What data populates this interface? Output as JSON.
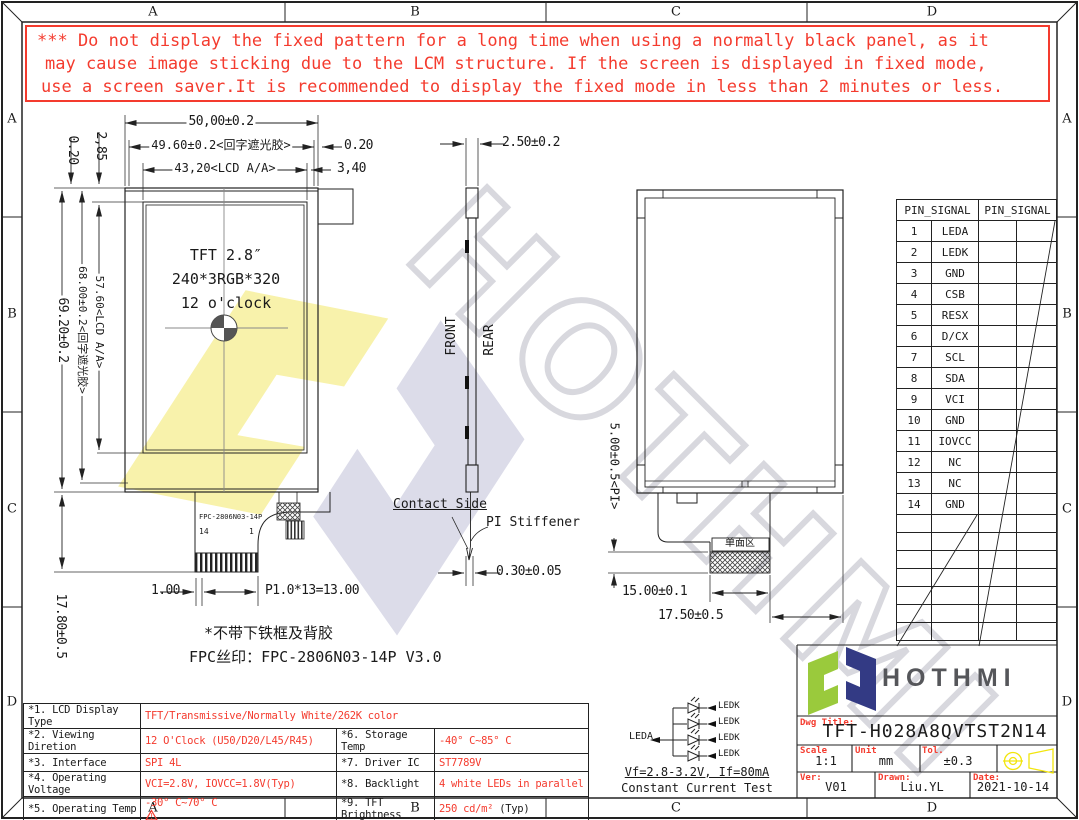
{
  "frame": {
    "cols": [
      "A",
      "B",
      "C",
      "D"
    ],
    "rows": [
      "A",
      "B",
      "C",
      "D"
    ]
  },
  "warning": {
    "line1": "*** Do not display the fixed pattern for a long time when using a normally black panel, as it",
    "line2": "may cause image sticking due to the LCM structure. If the screen is displayed in fixed mode,",
    "line3": "use a screen saver.It is recommended to display the fixed mode in less than 2 minutes or less."
  },
  "front_view": {
    "dim_width_outer": "50,00±0.2",
    "dim_width_mask": "49.60±0.2<回字遮光胶>",
    "dim_mask_gap": "0.20",
    "dim_width_aa": "43,20<LCD A/A>",
    "dim_aa_gap": "3,40",
    "dim_top_offset1": "2,85",
    "dim_top_offset2": "0.20",
    "dim_height_outer": "69.20±0.2",
    "dim_height_mask": "68.00±0.2<回字遮光胶>",
    "dim_height_aa": "57.60<LCD A/A>",
    "dim_fpc_drop": "17.80±0.5",
    "panel_line1": "TFT 2.8″",
    "panel_line2": "240*3RGB*320",
    "panel_line3": "12 o'clock",
    "fpc_silk": "FPC-2806N03-14P",
    "fpc_pin_left": "14",
    "fpc_pin_right": "1",
    "dim_finger_margin": "1.00",
    "dim_finger_pitch": "P1.0*13=13.00",
    "note_no_frame": "*不带下铁框及背胶",
    "note_silk": "FPC丝印：FPC-2806N03-14P V3.0"
  },
  "side_view": {
    "dim_thickness": "2.50±0.2",
    "label_front": "FRONT",
    "label_rear": "REAR",
    "label_contact": "Contact Side",
    "label_stiffener": "PI Stiffener",
    "dim_fpc_thickness": "0.30±0.05"
  },
  "rear_view": {
    "dim_pi": "5.00±0.5<PI>",
    "label_single_side": "单面区",
    "dim_fpc_width": "15.00±0.1",
    "dim_fpc_offset": "17.50±0.5"
  },
  "pin_table": {
    "header_left": "PIN_SIGNAL",
    "header_right": "PIN_SIGNAL",
    "rows": [
      [
        "1",
        "LEDA"
      ],
      [
        "2",
        "LEDK"
      ],
      [
        "3",
        "GND"
      ],
      [
        "4",
        "CSB"
      ],
      [
        "5",
        "RESX"
      ],
      [
        "6",
        "D/CX"
      ],
      [
        "7",
        "SCL"
      ],
      [
        "8",
        "SDA"
      ],
      [
        "9",
        "VCI"
      ],
      [
        "10",
        "GND"
      ],
      [
        "11",
        "IOVCC"
      ],
      [
        "12",
        "NC"
      ],
      [
        "13",
        "NC"
      ],
      [
        "14",
        "GND"
      ]
    ]
  },
  "backlight": {
    "anode": "LEDA",
    "cathode": "LEDK",
    "rating": "Vf=2.8-3.2V, If=80mA",
    "test": "Constant Current Test"
  },
  "spec_table": {
    "r1_label": "*1. LCD Display Type",
    "r1_value": "TFT/Transmissive/Normally White/262K color",
    "rows": [
      {
        "l1": "*2. Viewing Diretion",
        "v1": "12 O'Clock (U50/D20/L45/R45)",
        "l2": "*6. Storage Temp",
        "v2": "-40° C~85° C",
        "v2_suffix": ""
      },
      {
        "l1": "*3. Interface",
        "v1": "SPI 4L",
        "l2": "*7. Driver IC",
        "v2": "ST7789V",
        "v2_suffix": ""
      },
      {
        "l1": "*4. Operating Voltage",
        "v1": "VCI=2.8V, IOVCC=1.8V(Typ)",
        "l2": "*8. Backlight",
        "v2": "4 white LEDs in parallel",
        "v2_suffix": ""
      },
      {
        "l1": "*5. Operating Temp",
        "v1": "-30° C~70° C",
        "l2": "*9. TFT Brightness",
        "v2": "250 cd/m²",
        "v2_suffix": "(Typ)"
      }
    ]
  },
  "title_block": {
    "brand": "HOTHMI",
    "dwg_title_label": "Dwg Title:",
    "dwg_title": "TFT-H028A8QVTST2N14",
    "scale_label": "Scale",
    "scale_value": "1:1",
    "unit_label": "Unit",
    "unit_value": "mm",
    "tol_label": "Tol.",
    "tol_value": "±0.3",
    "ver_label": "Ver:",
    "ver_value": "V01",
    "drawn_label": "Drawn:",
    "drawn_value": "Liu.YL",
    "date_label": "Date:",
    "date_value": "2021-10-14"
  },
  "watermark": {
    "text": "HOTHMI"
  },
  "colors": {
    "red": "#f43b2e",
    "line": "#1a1a1a",
    "logo_green": "#9aca3c",
    "logo_navy": "#333a84",
    "logo_gray": "#55565a",
    "symbol_yellow": "#f2e50c",
    "watermark_yellow": "#f8f2ab",
    "watermark_lavender": "#dcdce9",
    "watermark_gray": "#d8d8de"
  }
}
